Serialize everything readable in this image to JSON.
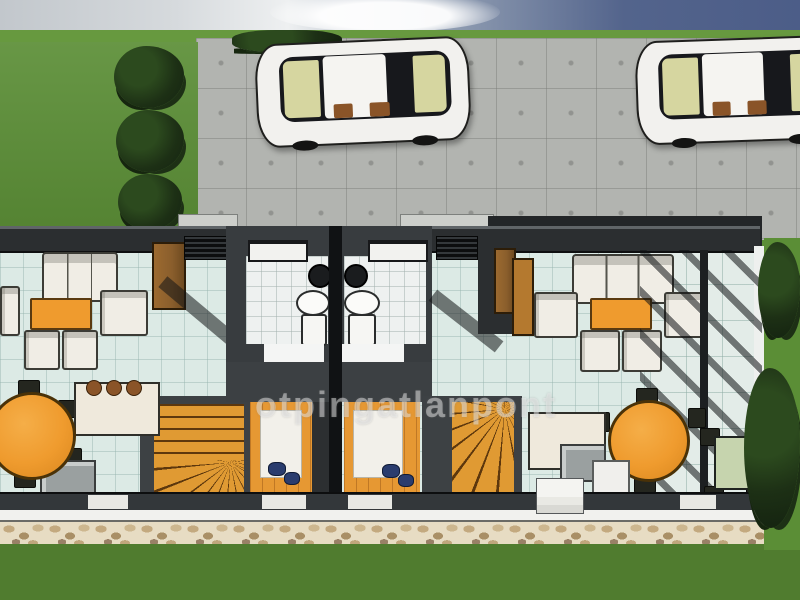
{
  "watermark": {
    "text": "otpingatlanpont"
  },
  "colors": {
    "sky_left": "#c2c7cc",
    "sky_right": "#53648c",
    "cloud": "#eef0f1",
    "grass_strip": "#67993f",
    "lawn": "#5b8e36",
    "lawn_bottom": "#507c2f",
    "foliage_dark": "#1d3015",
    "pavement": "#b2b4b0",
    "wall_dark": "#2b2e30",
    "wall_mid": "#3c4043",
    "party_wall": "#101214",
    "floor_tile": "#dceae5",
    "bathroom_floor": "#eef1f0",
    "accent_orange": "#ef9b2e",
    "stairs_orange": "#e09a33",
    "wood_floor": "#e69833",
    "wood_brown": "#8a5e2c",
    "sofa_white": "#f0ede5",
    "car_white": "#f2f1ee",
    "glass_tint": "#d6d6a0",
    "stone_base": "#e7dcc3",
    "stone_dark": "#a98f66",
    "outdoor_table": "#c6d4ae",
    "navy_item": "#2a3c6e",
    "watermark_color": "rgba(245,245,245,0.45)"
  }
}
